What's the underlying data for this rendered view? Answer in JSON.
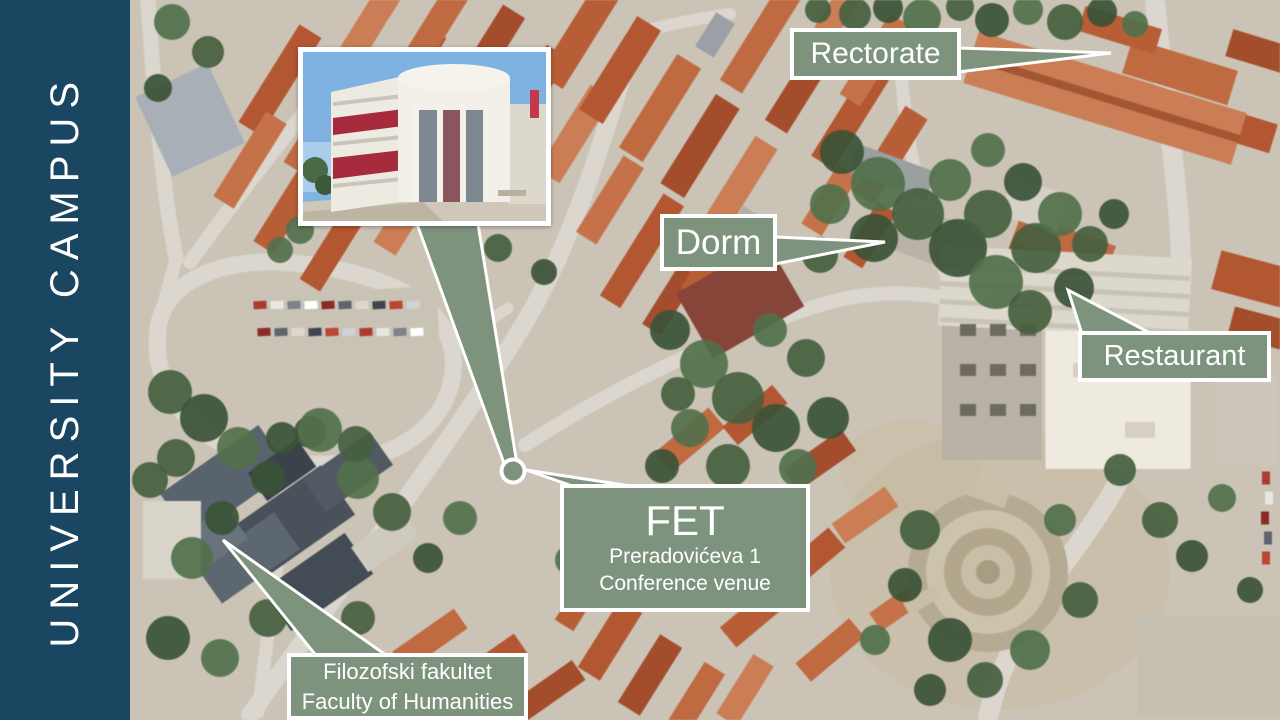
{
  "sidebar": {
    "title": "UNIVERSITY CAMPUS"
  },
  "callouts": {
    "rectorate": {
      "label": "Rectorate"
    },
    "dorm": {
      "label": "Dorm"
    },
    "restaurant": {
      "label": "Restaurant"
    },
    "fet": {
      "title": "FET",
      "line1": "Preradovićeva 1",
      "line2": "Conference venue"
    },
    "faculty": {
      "line1": "Filozofski fakultet",
      "line2": "Faculty of Humanities"
    }
  },
  "colors": {
    "sidebar_bg": "#1a4661",
    "callout_bg": "#7e937e",
    "callout_border": "#ffffff",
    "callout_text": "#ffffff"
  }
}
